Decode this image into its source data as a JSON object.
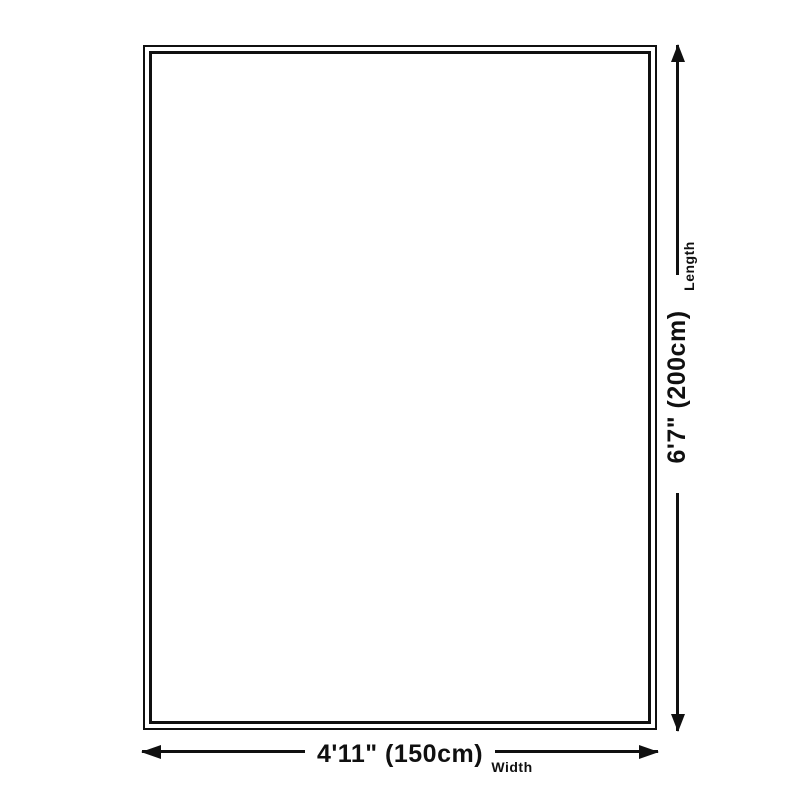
{
  "page": {
    "type": "product-dimension-diagram",
    "background_color": "#ffffff",
    "line_color": "#101010"
  },
  "dimensions": {
    "length": {
      "value": "6'7\" (200cm)",
      "label": "Length"
    },
    "width": {
      "value": "4'11\" (150cm)",
      "label": "Width"
    }
  }
}
